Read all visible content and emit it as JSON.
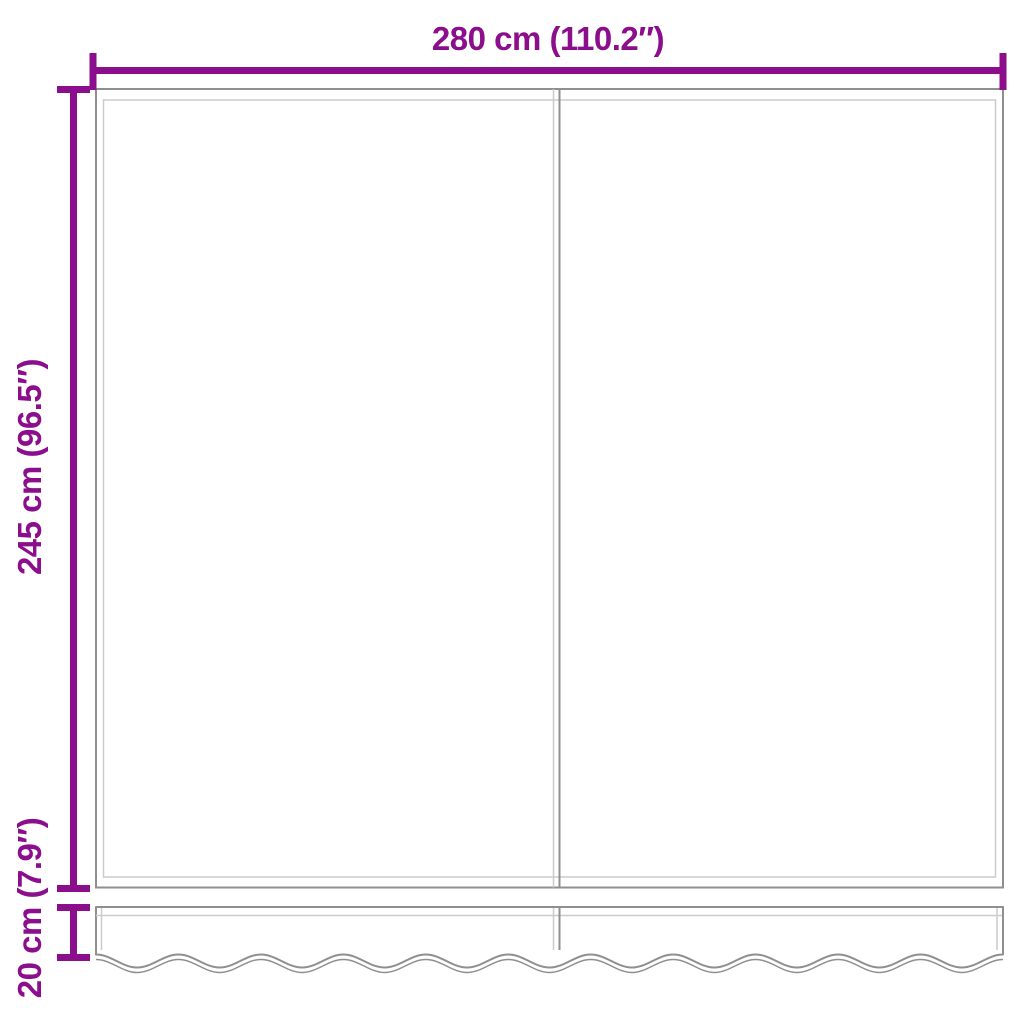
{
  "labels": {
    "width": "280 cm (110.2″)",
    "height": "245 cm (96.5″)",
    "valance_height": "20 cm (7.9″)"
  },
  "colors": {
    "dimension": "#8B0E8C",
    "outline_dark": "#8F8F8F",
    "outline_light": "#CBCBCB",
    "background": "#FFFFFF"
  }
}
